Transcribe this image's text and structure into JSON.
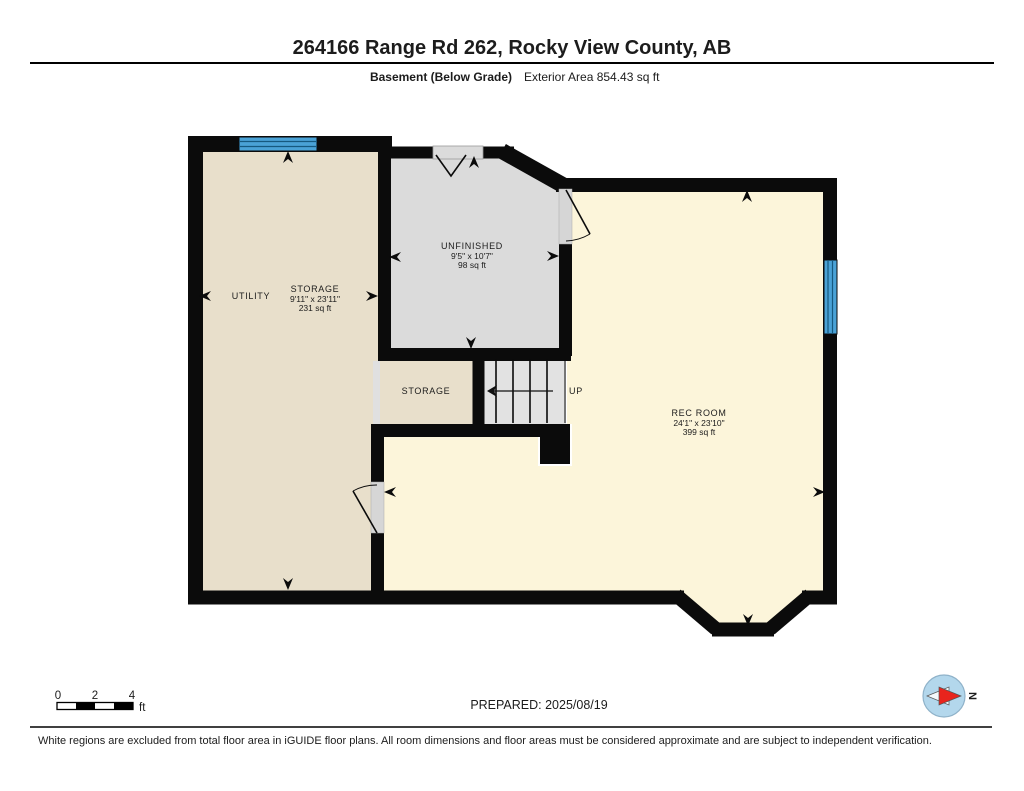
{
  "header": {
    "title": "264166 Range Rd 262, Rocky View County, AB",
    "floor_label": "Basement (Below Grade)",
    "exterior_area_label": "Exterior Area 854.43 sq ft"
  },
  "plan": {
    "rooms": {
      "utility": {
        "name": "UTILITY"
      },
      "storage_main": {
        "name": "STORAGE",
        "dims": "9'11\" x 23'11\"",
        "area": "231 sq ft"
      },
      "unfinished": {
        "name": "UNFINISHED",
        "dims": "9'5\" x 10'7\"",
        "area": "98 sq ft"
      },
      "storage_small": {
        "name": "STORAGE"
      },
      "rec_room": {
        "name": "REC ROOM",
        "dims": "24'1\" x 23'10\"",
        "area": "399 sq ft"
      }
    },
    "stairs": {
      "direction_label": "UP"
    }
  },
  "scale_bar": {
    "ticks": [
      "0",
      "2",
      "4"
    ],
    "unit": "ft"
  },
  "compass": {
    "label": "N"
  },
  "footer": {
    "prepared": "PREPARED: 2025/08/19",
    "disclaimer": "White regions are excluded from total floor area in iGUIDE floor plans. All room dimensions and floor areas must be considered approximate and are subject to independent verification."
  },
  "colors": {
    "wall": "#0b0b0b",
    "room_beige": "#e8dfcb",
    "room_gray": "#dbdbdb",
    "room_cream": "#fcf5da",
    "stairs_gray": "#e2e2e2",
    "window_blue": "#4aa2d6",
    "compass_blue": "#b3d7ec",
    "compass_red": "#e8241d"
  }
}
